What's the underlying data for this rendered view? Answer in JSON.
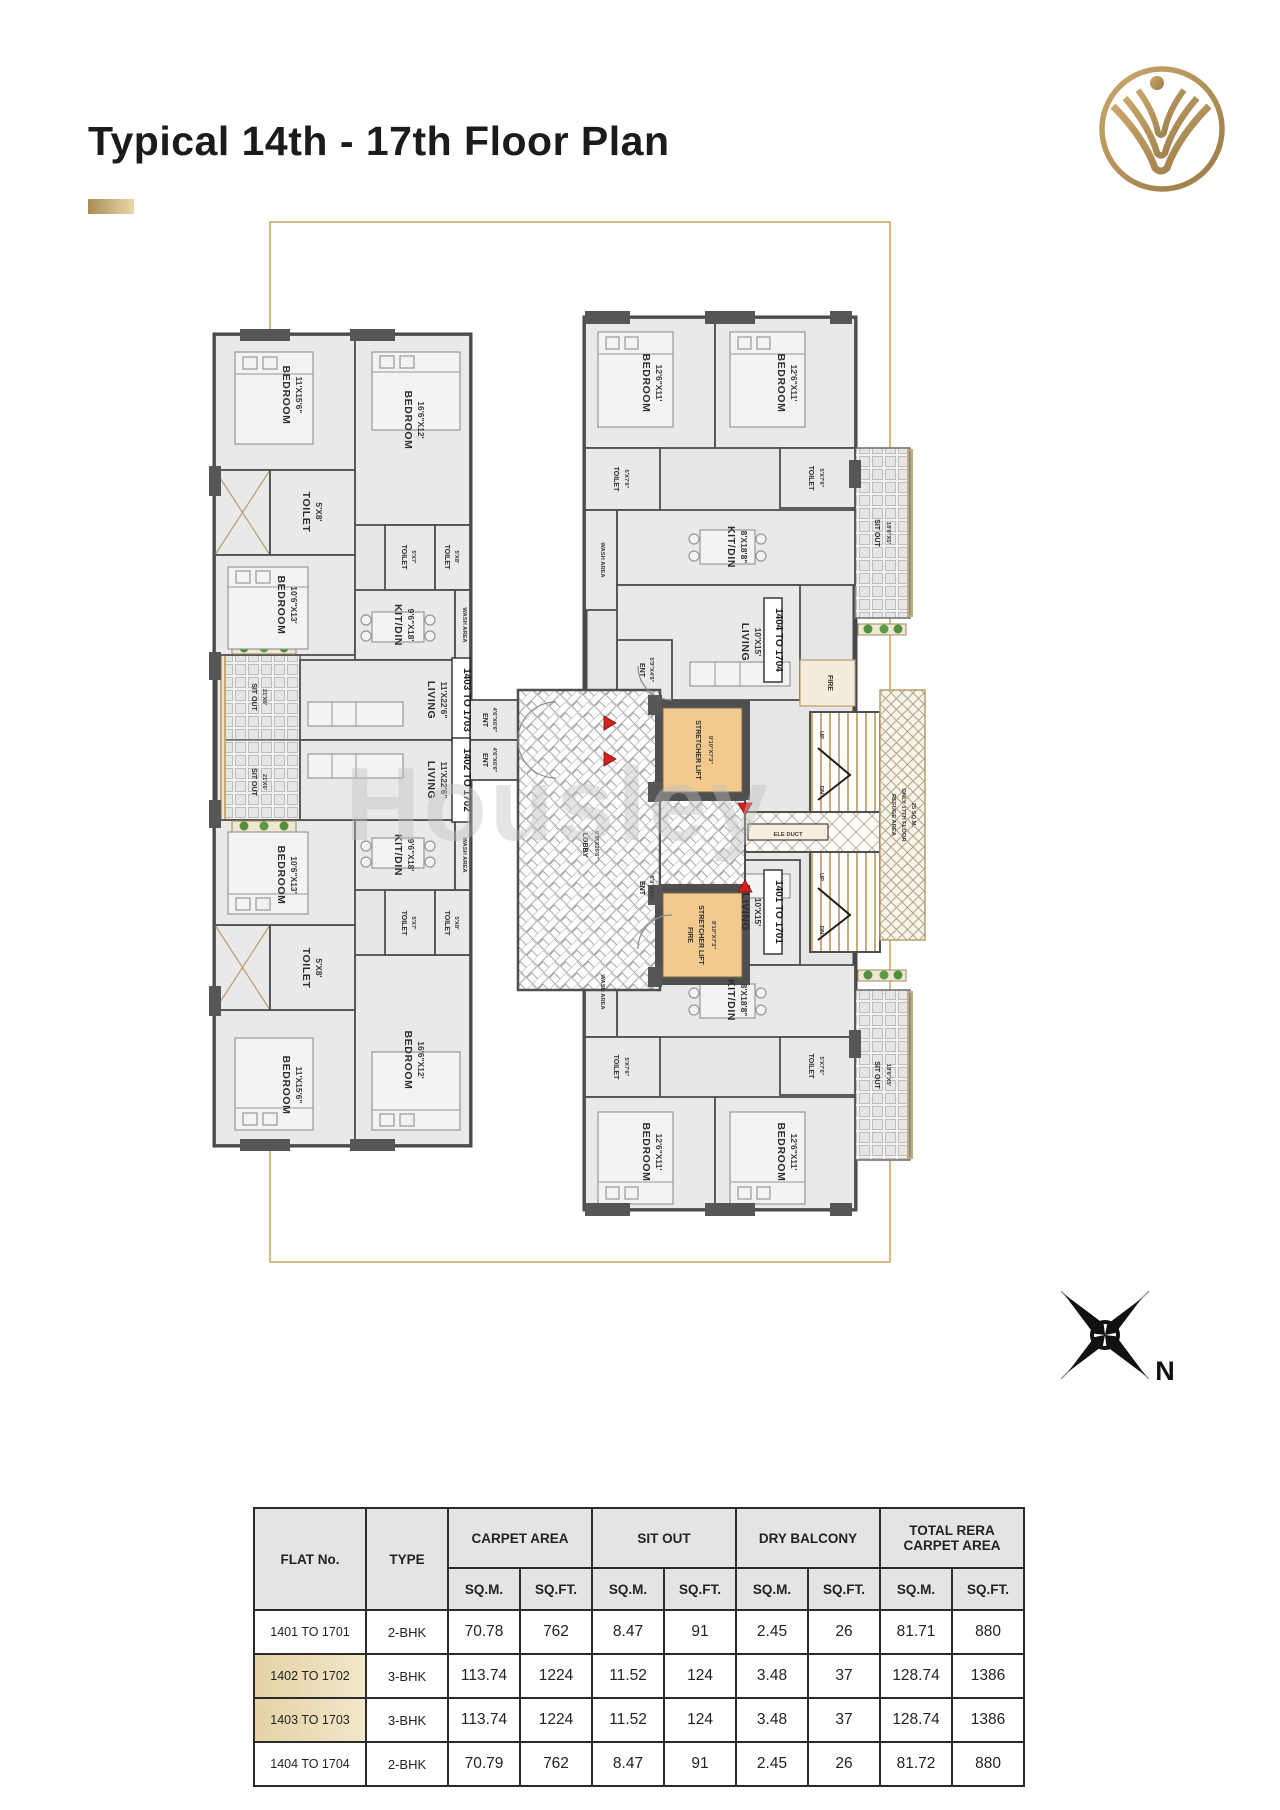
{
  "page": {
    "title": "Typical 14th - 17th Floor Plan"
  },
  "watermark": "Housley",
  "compass": {
    "north": "N"
  },
  "colors": {
    "accent_gold": "#b7985f",
    "table_highlight": "#e7d7b2",
    "lift_fill": "#f2ca8e",
    "wall": "#4f4f4f"
  },
  "plan": {
    "rooms": {
      "bedroom": "BEDROOM",
      "toilet": "TOILET",
      "kitdin": "KIT/DIN",
      "living": "LIVING",
      "ent": "ENT",
      "sitout": "SIT OUT",
      "wash": "WASH AREA",
      "lobby": "LOBBY",
      "stretcher": "STRETCHER LIFT",
      "fire_word": "FIRE",
      "up": "UP",
      "dn": "DN",
      "ele_duct": "ELE DUCT",
      "refuge1": "REFUGE AREA",
      "refuge2": "ONLY 17TH FLOOR",
      "refuge3": "25 SQ.M."
    },
    "dims": {
      "bed_11x156": "11'X15'6\"",
      "bed_166x12": "16'6\"X12'",
      "bed_106x13": "10'6\"X13'",
      "bed_126x11": "12'6\"X11'",
      "toilet_5x8": "5'X8'",
      "toilet_5x7": "5'X7'",
      "toilet_5x76": "5'X7'6\"",
      "kitdin_96x18": "9'6\"X18'",
      "kitdin_8x188": "8'X18'8\"",
      "living_11x226": "11'X22'6\"",
      "living_10x15": "10'X15'",
      "ent_46x66": "4'6\"X6'6\"",
      "ent_59x46": "5'9\"X4'6\"",
      "sitout_21x6": "21'X6'",
      "sitout_186x5": "18'6\"X5'",
      "lift_910x73": "9'10\"X7'3\"",
      "lobby_98x206": "9'8\"X20'6\""
    },
    "units": {
      "u1401": "1401 TO 1701",
      "u1402": "1402 TO 1702",
      "u1403": "1403 TO 1703",
      "u1404": "1404 TO 1704"
    }
  },
  "table": {
    "headers": {
      "flat_no": "FLAT No.",
      "type": "TYPE",
      "carpet_area": "CARPET AREA",
      "sit_out": "SIT OUT",
      "dry_balcony": "DRY BALCONY",
      "total_rera": "TOTAL RERA CARPET  AREA",
      "sqm": "SQ.M.",
      "sqft": "SQ.FT."
    },
    "rows": [
      {
        "flat": "1401 TO 1701",
        "type": "2-BHK",
        "carpet_sqm": "70.78",
        "carpet_sqft": "762",
        "sitout_sqm": "8.47",
        "sitout_sqft": "91",
        "dry_sqm": "2.45",
        "dry_sqft": "26",
        "total_sqm": "81.71",
        "total_sqft": "880"
      },
      {
        "flat": "1402 TO 1702",
        "type": "3-BHK",
        "carpet_sqm": "113.74",
        "carpet_sqft": "1224",
        "sitout_sqm": "11.52",
        "sitout_sqft": "124",
        "dry_sqm": "3.48",
        "dry_sqft": "37",
        "total_sqm": "128.74",
        "total_sqft": "1386"
      },
      {
        "flat": "1403 TO 1703",
        "type": "3-BHK",
        "carpet_sqm": "113.74",
        "carpet_sqft": "1224",
        "sitout_sqm": "11.52",
        "sitout_sqft": "124",
        "dry_sqm": "3.48",
        "dry_sqft": "37",
        "total_sqm": "128.74",
        "total_sqft": "1386"
      },
      {
        "flat": "1404 TO 1704",
        "type": "2-BHK",
        "carpet_sqm": "70.79",
        "carpet_sqft": "762",
        "sitout_sqm": "8.47",
        "sitout_sqft": "91",
        "dry_sqm": "2.45",
        "dry_sqft": "26",
        "total_sqm": "81.72",
        "total_sqft": "880"
      }
    ]
  }
}
